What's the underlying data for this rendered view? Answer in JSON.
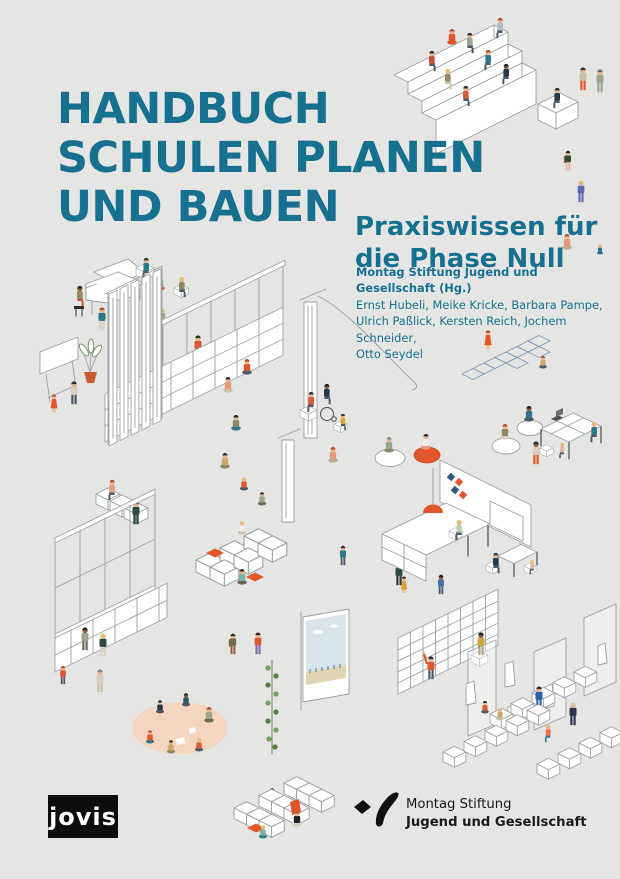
{
  "cover": {
    "title": {
      "line1": "HANDBUCH",
      "line2": "SCHULEN PLANEN",
      "line3": "UND BAUEN"
    },
    "subtitle": {
      "line1": "Praxiswissen für",
      "line2": "die Phase Null"
    },
    "credits": {
      "editor": "Montag Stiftung Jugend und Gesellschaft (Hg.)",
      "authors_line1": "Ernst Hubeli, Meike Kricke, Barbara Pampe,",
      "authors_line2": "Ulrich Paßlick, Kersten Reich, Jochem Schneider,",
      "authors_line3": "Otto Seydel"
    },
    "publisher": {
      "logo_text": "jovis"
    },
    "foundation": {
      "name_line1": "Montag Stiftung",
      "name_line2": "Jugend und Gesellschaft"
    },
    "colors": {
      "background": "#e5e5e3",
      "title_teal": "#16708f",
      "accent_orange": "#e2572a",
      "ink": "#1a1a1a"
    },
    "illustration": {
      "style": "isometric white line-art school furniture with small colorful figures",
      "scenes": [
        "tiered-seating-steps",
        "grand-piano-corner",
        "whiteboard-easel",
        "potted-plant",
        "window-shelf-wall-with-curtains",
        "hopscotch-game",
        "bean-bag-readers",
        "group-work-tables",
        "pin-board-with-notes",
        "project-table-with-lamp",
        "small-tutor-table",
        "window-bench-shelf",
        "soft-seating-blocks",
        "reading-circle-rug",
        "projection-screen",
        "climbing-plant",
        "library-shelf",
        "cloakroom-benches",
        "seating-blocks-bottom"
      ]
    }
  }
}
